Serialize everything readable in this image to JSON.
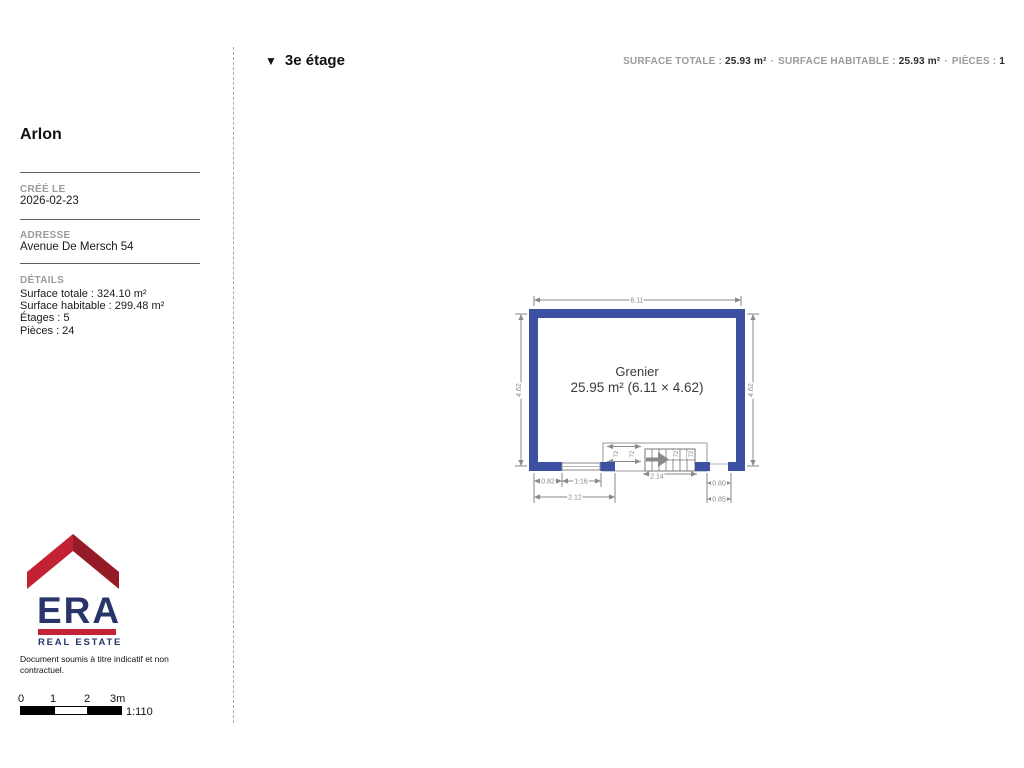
{
  "header": {
    "triangle_icon": "▼",
    "floor_label": "3e étage",
    "stats_separator": "·",
    "stats": [
      {
        "label": "SURFACE TOTALE :",
        "value": "25.93 m²"
      },
      {
        "label": "SURFACE HABITABLE :",
        "value": "25.93 m²"
      },
      {
        "label": "PIÈCES :",
        "value": "1"
      }
    ]
  },
  "sidebar": {
    "title": "Arlon",
    "created": {
      "label": "CRÉÉ LE",
      "value": "2026-02-23"
    },
    "address": {
      "label": "ADRESSE",
      "value": "Avenue De Mersch 54"
    },
    "details": {
      "label": "DÉTAILS",
      "lines": [
        "Surface totale : 324.10 m²",
        "Surface habitable : 299.48 m²",
        "Étages : 5",
        "Pièces : 24"
      ]
    },
    "logo": {
      "brand": "ERA",
      "tagline": "REAL ESTATE"
    },
    "disclaimer": "Document soumis à titre indicatif et non contractuel.",
    "scalebar": {
      "ticks": [
        "0",
        "1",
        "2",
        "3m"
      ],
      "ratio": "1:110"
    }
  },
  "floorplan": {
    "room_name": "Grenier",
    "room_area": "25.95 m² (6.11 × 4.62)",
    "dims": {
      "top": "6.11",
      "left": "4.62",
      "right": "4.62",
      "bottom_left_1": "0.82",
      "bottom_left_2": "1.16",
      "bottom_left_total": "2.12",
      "bottom_right_1": "0.80",
      "bottom_right_2": "0.85",
      "stair_width": "2.14",
      "stair_step_1": "72",
      "stair_step_2": "72",
      "stair_step_3": "72",
      "stair_step_4": "72"
    },
    "colors": {
      "wall": "#3E50A4",
      "dimension": "#8a8a8a"
    }
  },
  "brand_colors": {
    "red": "#C22233",
    "red_dark": "#951C27",
    "navy": "#27356B"
  }
}
